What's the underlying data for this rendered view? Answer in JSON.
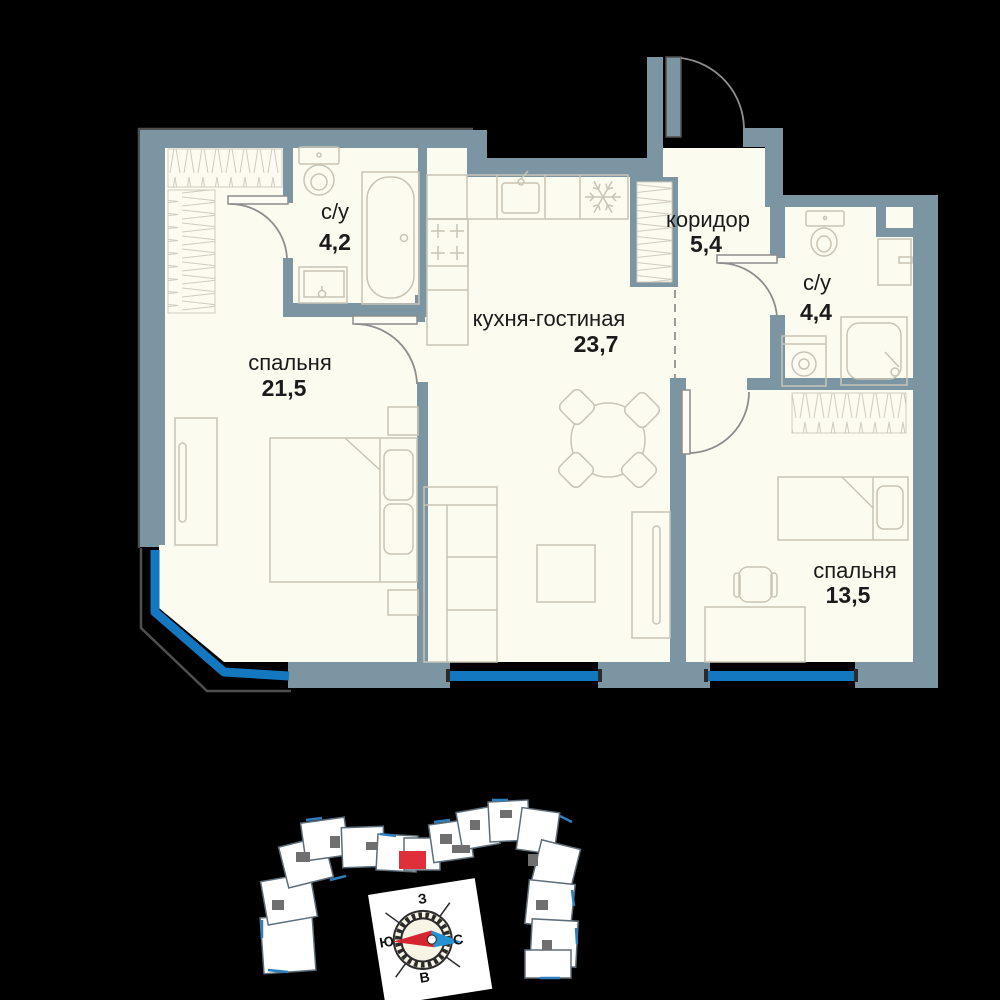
{
  "plan": {
    "rooms": [
      {
        "id": "bathroom-1",
        "name": "с/у",
        "area": "4,2"
      },
      {
        "id": "bedroom-1",
        "name": "спальня",
        "area": "21,5"
      },
      {
        "id": "kitchen-living",
        "name": "кухня-гостиная",
        "area": "23,7"
      },
      {
        "id": "corridor",
        "name": "коридор",
        "area": "5,4"
      },
      {
        "id": "bathroom-2",
        "name": "с/у",
        "area": "4,4"
      },
      {
        "id": "bedroom-2",
        "name": "спальня",
        "area": "13,5"
      }
    ]
  },
  "compass": {
    "top": "З",
    "left": "Ю",
    "right": "С",
    "bottom": "В"
  },
  "colors": {
    "wall": "#7c95a2",
    "floor": "#fcfbef",
    "window_blue": "#1478c0",
    "highlight_red": "#df2f3a",
    "compass_red": "#d6252e",
    "compass_blue": "#2593d3"
  }
}
